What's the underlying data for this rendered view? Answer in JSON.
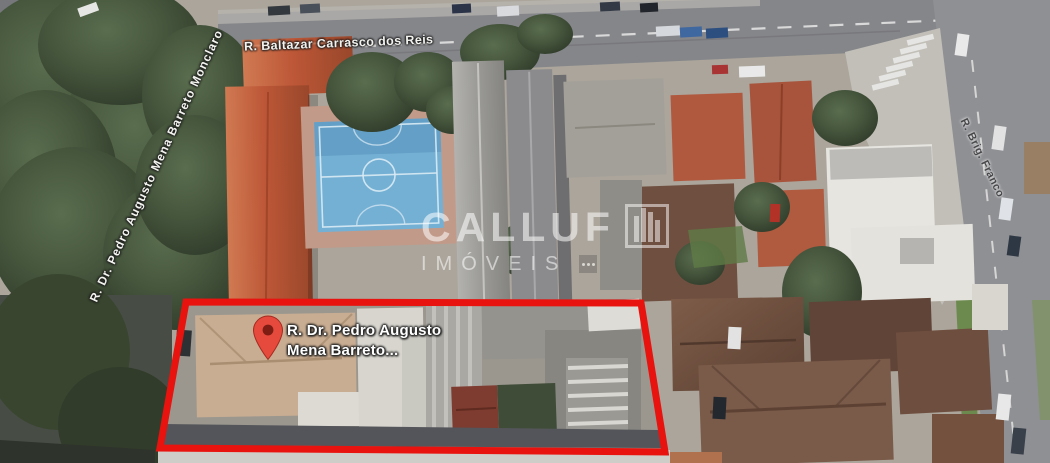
{
  "map": {
    "street_labels": {
      "top": "R. Baltazar Carrasco dos Reis",
      "left": "R. Dr. Pedro Augusto Mena Barreto Monclaro",
      "right": "R. Brig. Franco"
    },
    "pin": {
      "label_line1": "R. Dr. Pedro Augusto",
      "label_line2": "Mena Barreto..."
    },
    "watermark": {
      "brand": "CALLUF",
      "suffix": "IMÓVEIS"
    },
    "colors": {
      "highlight_outline": "#e8120e",
      "pin_red": "#e64a3c",
      "pin_hole": "#7d1d14",
      "court_blue": "#74b0d4"
    }
  }
}
